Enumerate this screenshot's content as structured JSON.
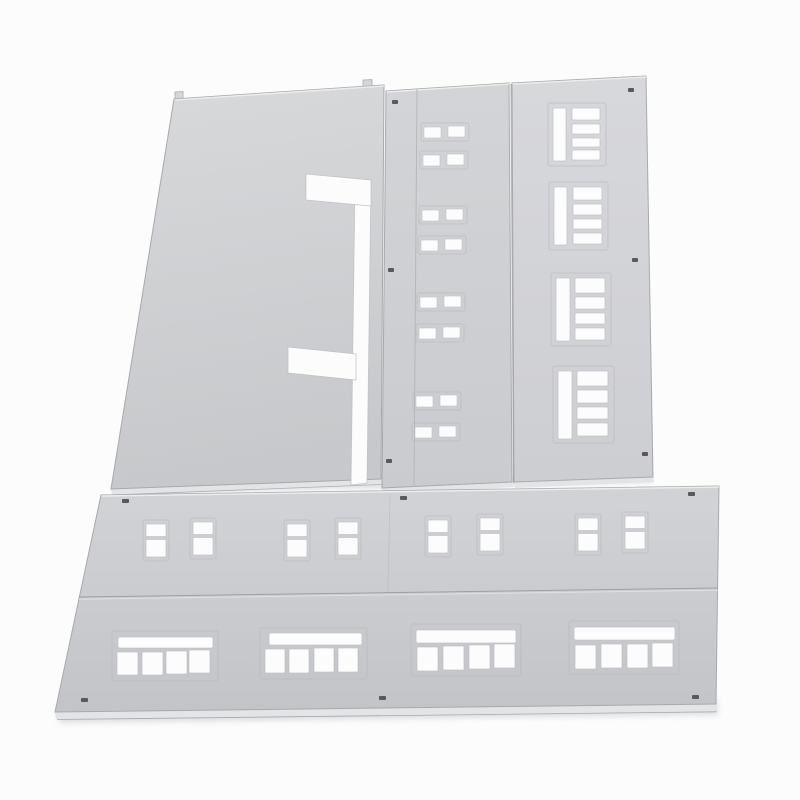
{
  "scene": {
    "type": "product-photo",
    "description": "Four light-gray injection-molded plastic wall panels of a scale-model building kit laid flat on a white background",
    "background": "#fcfcfd"
  },
  "colors": {
    "background": "#fcfcfd",
    "panel_light": "#d8d9db",
    "panel_mid": "#d2d4d7",
    "panel_dark": "#c2c4c7",
    "edge_line": "#a8a9ad",
    "top_highlight": "#eef0f1",
    "cutout_white": "#fcfcfd",
    "frame_ridge": "#b6b7bb",
    "seam_line": "#9fa0a4",
    "mold_hole": "#4e4f53"
  },
  "panels": [
    {
      "id": "left-blank-wall",
      "label": "Blank wall panel with bracket-shaped notch cut into right edge",
      "window_cutouts": 0,
      "alignment_pegs": 2
    },
    {
      "id": "middle-small-window-wall",
      "label": "Tall wall panel with four stacked pairs of small rectangular window openings",
      "window_cutouts": 16
    },
    {
      "id": "right-louver-window-wall",
      "label": "Tall wall panel with four louvered window openings (side slot plus four slats)",
      "window_cutouts": 4
    },
    {
      "id": "bottom-storefront-wall",
      "label": "Wide two-story wall panel: four pairs of two-pane windows above, four storefront window groups below",
      "two_pane_windows": 8,
      "storefront_groups": 4
    }
  ]
}
